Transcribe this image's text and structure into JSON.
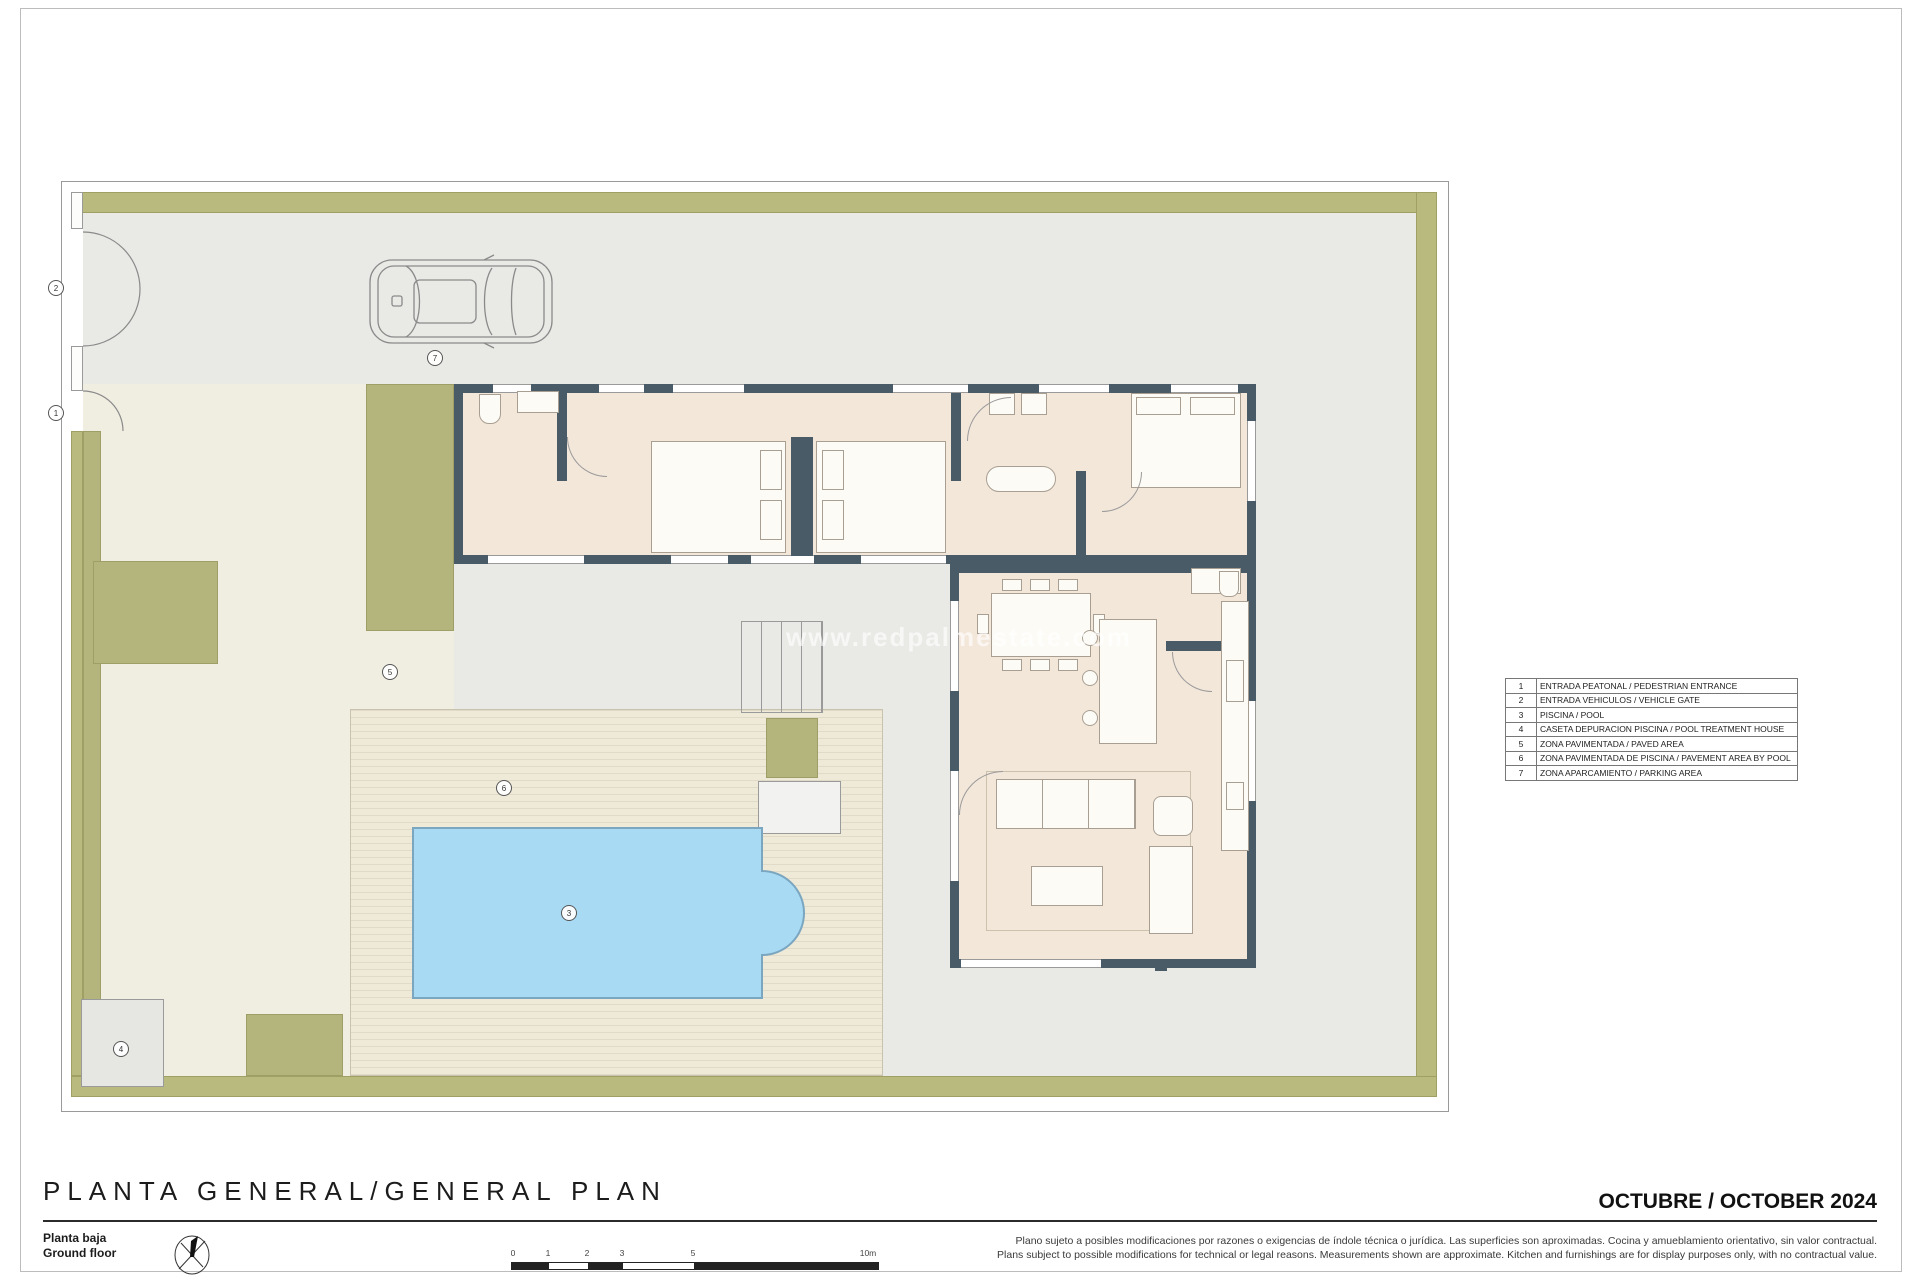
{
  "plan": {
    "watermark": "www.redpalmestate.com",
    "markers": [
      {
        "num": "1",
        "meaning": "pedestrian entrance"
      },
      {
        "num": "2",
        "meaning": "vehicle gate"
      },
      {
        "num": "3",
        "meaning": "pool"
      },
      {
        "num": "4",
        "meaning": "pool treatment house"
      },
      {
        "num": "5",
        "meaning": "paved area"
      },
      {
        "num": "6",
        "meaning": "pavement area by pool"
      },
      {
        "num": "7",
        "meaning": "parking area"
      }
    ]
  },
  "legend": {
    "rows": [
      {
        "num": "1",
        "text": "ENTRADA PEATONAL / PEDESTRIAN ENTRANCE"
      },
      {
        "num": "2",
        "text": "ENTRADA VEHICULOS / VEHICLE GATE"
      },
      {
        "num": "3",
        "text": "PISCINA / POOL"
      },
      {
        "num": "4",
        "text": "CASETA DEPURACION PISCINA / POOL TREATMENT HOUSE"
      },
      {
        "num": "5",
        "text": "ZONA PAVIMENTADA / PAVED AREA"
      },
      {
        "num": "6",
        "text": "ZONA PAVIMENTADA DE PISCINA / PAVEMENT AREA BY POOL"
      },
      {
        "num": "7",
        "text": "ZONA APARCAMIENTO / PARKING AREA"
      }
    ]
  },
  "titleblock": {
    "title": "PLANTA GENERAL/GENERAL PLAN",
    "floor_es": "Planta baja",
    "floor_en": "Ground floor",
    "date": "OCTUBRE / OCTOBER 2024",
    "disclaimer_es": "Plano sujeto a posibles modificaciones por razones o exigencias de índole técnica o jurídica. Las superficies son aproximadas. Cocina y amueblamiento orientativo, sin valor contractual.",
    "disclaimer_en": "Plans subject to possible modifications for technical or legal reasons. Measurements shown are approximate. Kitchen and furnishings are for display purposes only, with no contractual value."
  },
  "scale": {
    "labels": [
      "0",
      "1",
      "2",
      "3",
      "5",
      "10m"
    ]
  },
  "colors": {
    "hedge": "#b9ba7d",
    "paved_gray": "#e9e9e6",
    "paved_cream": "#f0ede1",
    "grass": "#b3b57c",
    "pool_fill": "#a9daf4",
    "pool_edge": "#7aa6c0",
    "wall": "#4a5b68",
    "floor": "#f3e7da"
  }
}
